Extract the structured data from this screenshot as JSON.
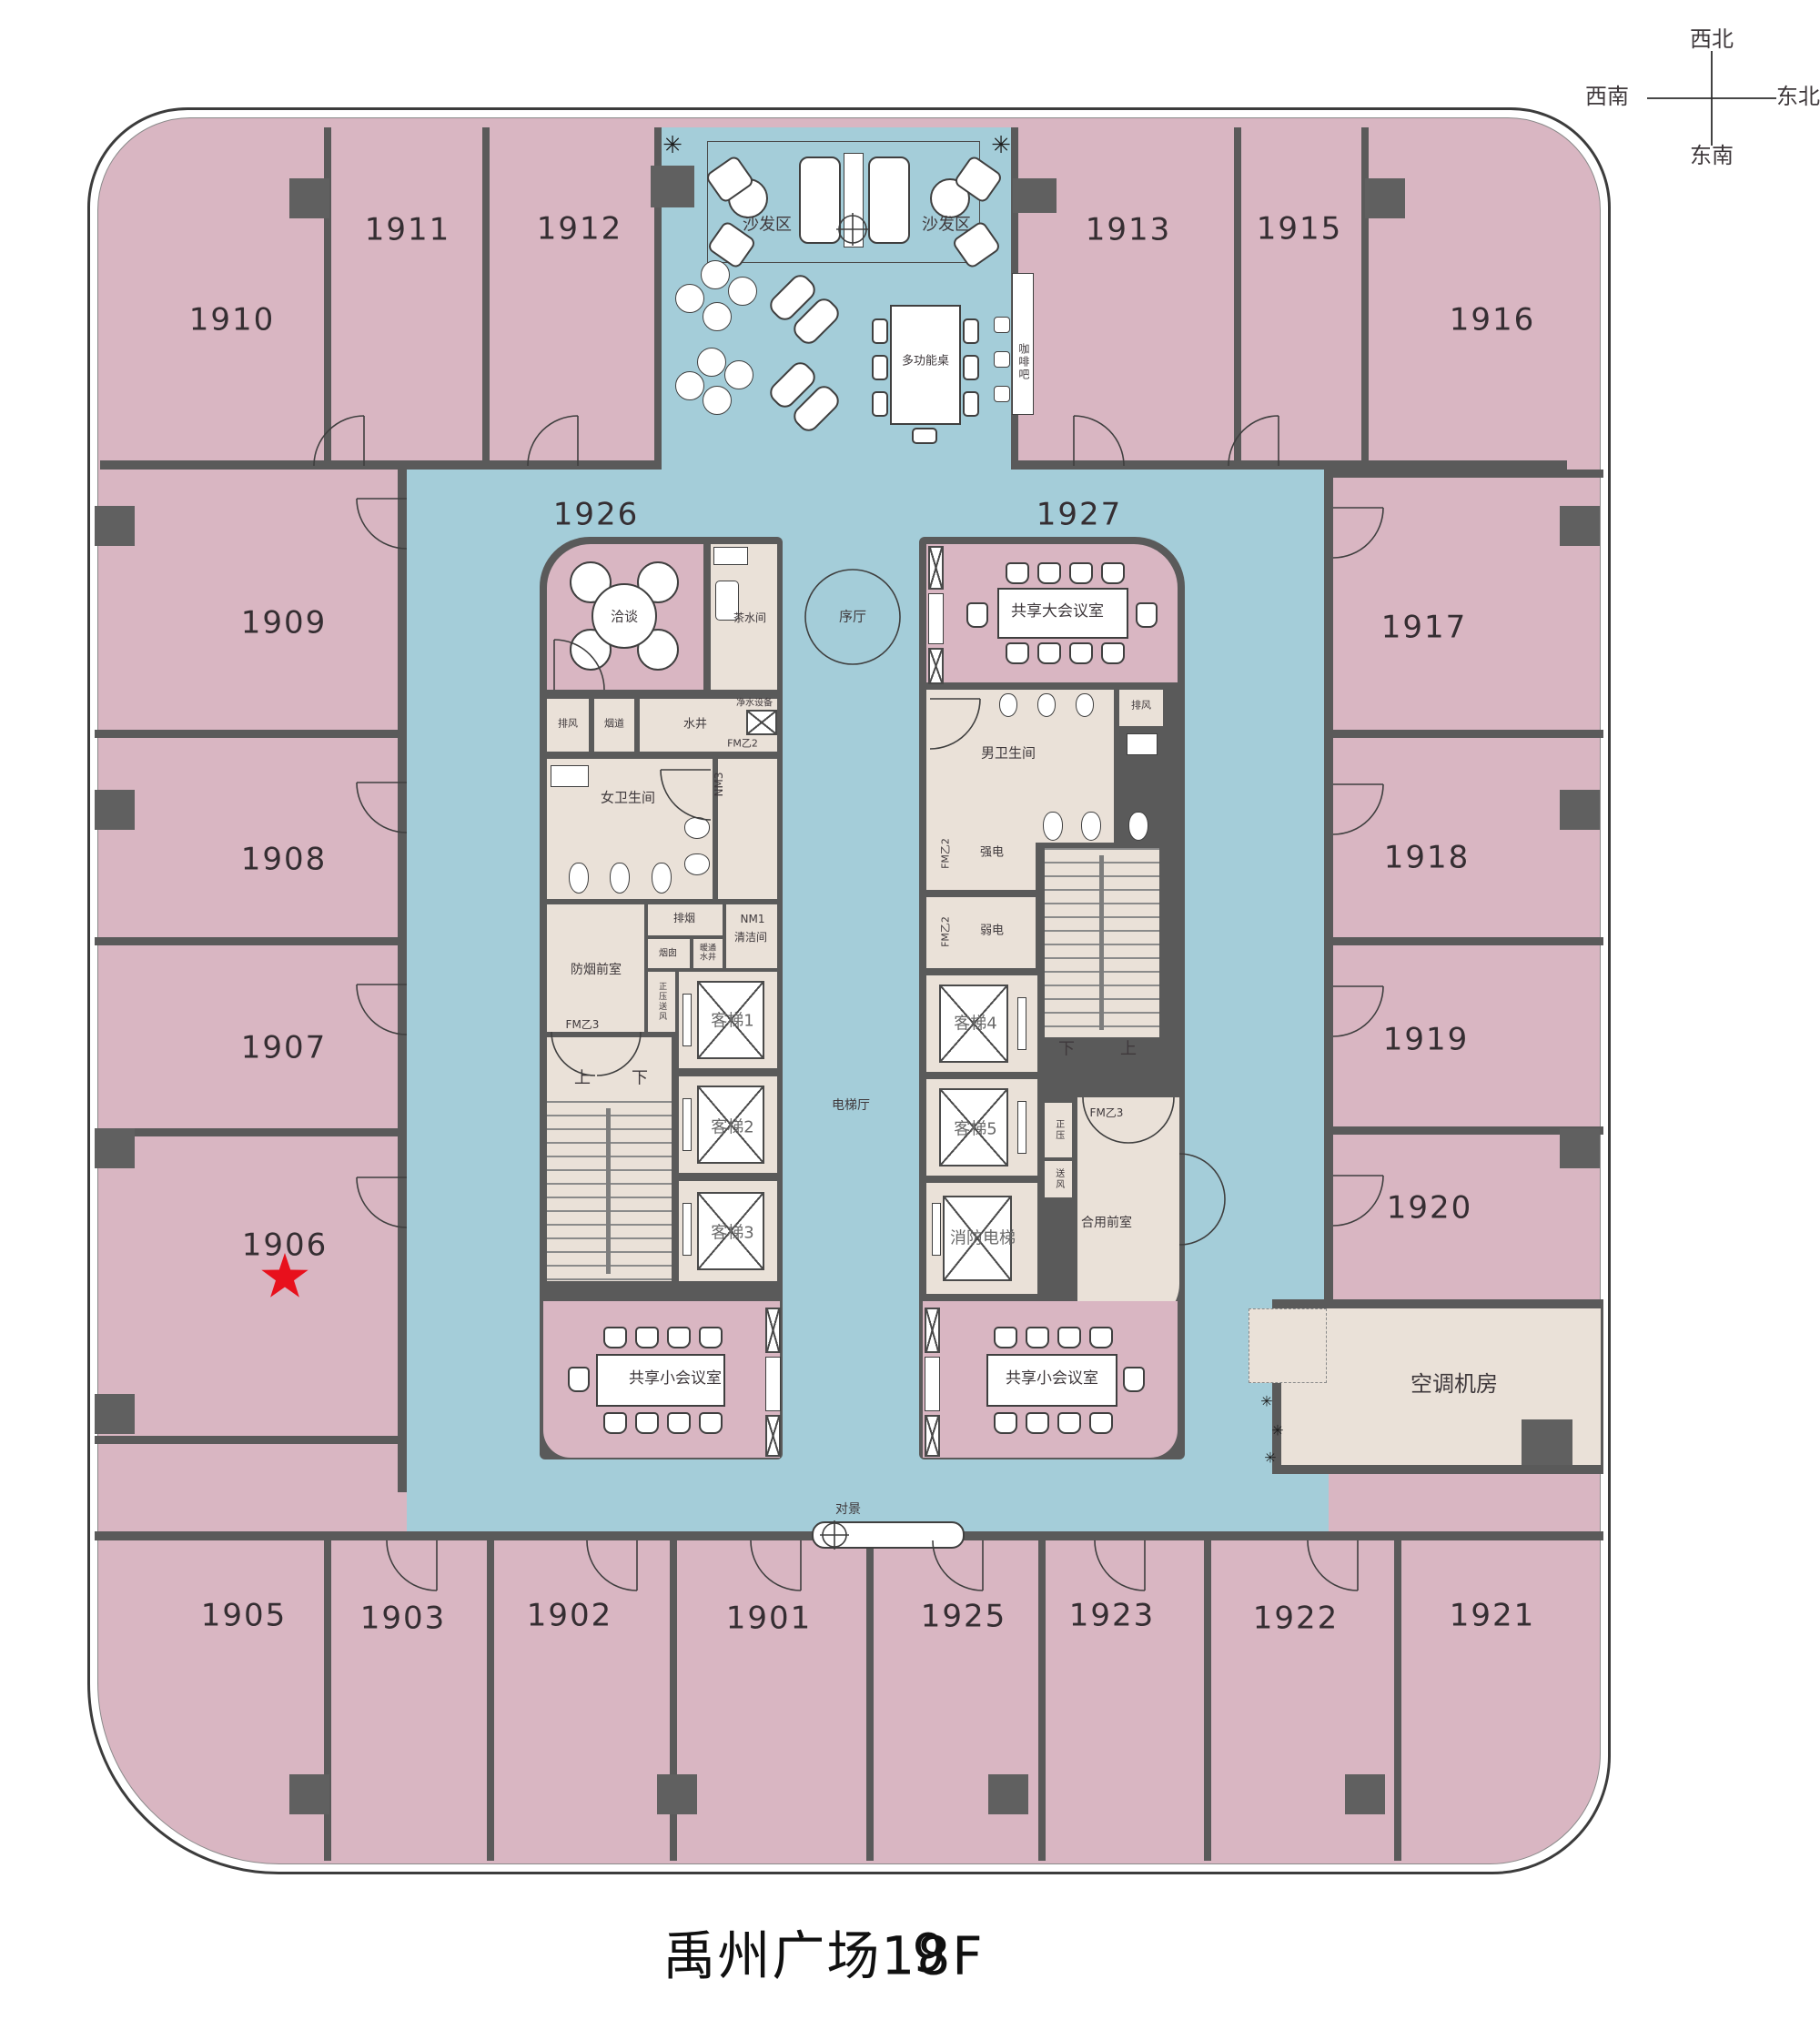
{
  "title": {
    "prefix": "禹州广场1",
    "digit_back": "8",
    "digit_front": "9",
    "suffix": "F"
  },
  "compass": {
    "top": "西北",
    "right": "东北",
    "left": "西南",
    "bottom": "东南"
  },
  "rooms": {
    "r1901": "1901",
    "r1902": "1902",
    "r1903": "1903",
    "r1905": "1905",
    "r1906": "1906",
    "r1907": "1907",
    "r1908": "1908",
    "r1909": "1909",
    "r1910": "1910",
    "r1911": "1911",
    "r1912": "1912",
    "r1913": "1913",
    "r1915": "1915",
    "r1916": "1916",
    "r1917": "1917",
    "r1918": "1918",
    "r1919": "1919",
    "r1920": "1920",
    "r1921": "1921",
    "r1922": "1922",
    "r1923": "1923",
    "r1925": "1925",
    "r1926": "1926",
    "r1927": "1927"
  },
  "lounge": {
    "sofa_area_left": "沙发区",
    "sofa_area_right": "沙发区",
    "multi_table": "多功能桌",
    "coffee_bar": "咖啡吧"
  },
  "center": {
    "foyer": "序厅",
    "elevator_hall": "电梯厅",
    "feature_view": "对景"
  },
  "core_left": {
    "negotiation": "洽谈",
    "tea_room": "茶水间",
    "water_purifier": "净水设备",
    "exhaust": "排风",
    "flue": "烟道",
    "water_shaft": "水井",
    "fm_b2": "FM乙2",
    "nm3": "NM3",
    "womens_room": "女卫生间",
    "smoke_exhaust": "排烟",
    "chimney": "烟囱",
    "hvac_shaft": "暖通水井",
    "nm1": "NM1",
    "cleaning_room": "清洁间",
    "smoke_lobby": "防烟前室",
    "fm_b3": "FM乙3",
    "pressure_air": "正压送风",
    "lift1": "客梯1",
    "lift2": "客梯2",
    "lift3": "客梯3",
    "up": "上",
    "down": "下",
    "small_meeting": "共享小会议室"
  },
  "core_right": {
    "large_meeting": "共享大会议室",
    "mens_room": "男卫生间",
    "exhaust": "排风",
    "fm_b2_a": "FM乙2",
    "fm_b2_b": "FM乙2",
    "strong_elec": "强电",
    "weak_elec": "弱电",
    "lift4": "客梯4",
    "lift5": "客梯5",
    "fire_lift": "消防电梯",
    "pressure_a": "正压",
    "pressure_b": "送风",
    "fm_b3": "FM乙3",
    "shared_lobby": "合用前室",
    "down": "下",
    "up": "上",
    "small_meeting": "共享小会议室"
  },
  "hvac": {
    "label": "空调机房"
  },
  "colors": {
    "room_pink": "#d9b6c2",
    "corridor_blue": "#a4cdd9",
    "core_beige": "#eae1d8",
    "wall_gray": "#5a5a5a",
    "star_red": "#e8101c"
  }
}
